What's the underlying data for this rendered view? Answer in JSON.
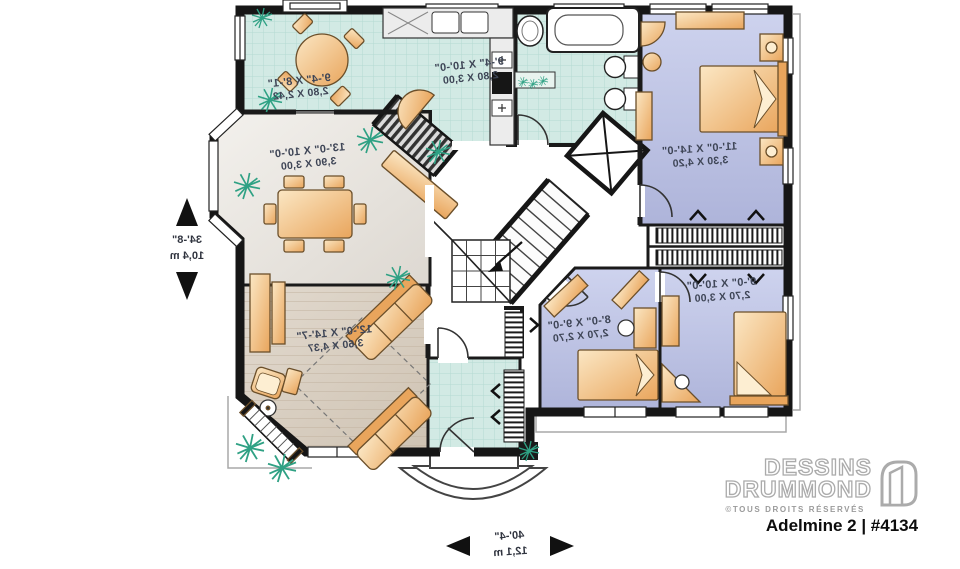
{
  "plan": {
    "rooms": {
      "breakfast": {
        "imperial": "9'-4\" X 8'-1\"",
        "metric": "2,80 X 2,42"
      },
      "kitchen": {
        "imperial": "9'-4\" X 10'-0\"",
        "metric": "2,80 X 3,00"
      },
      "dining": {
        "imperial": "13'-0\" X 10'-0\"",
        "metric": "3,90 X 3,00"
      },
      "living": {
        "imperial": "12'-0\" X 14'-7\"",
        "metric": "3,60 X 4,37"
      },
      "master_bedroom": {
        "imperial": "11'-0\" X 14'-0\"",
        "metric": "3,30 X 4,20"
      },
      "bedroom_2": {
        "imperial": "8'-0\" X 9'-0\"",
        "metric": "2,70 X 2,70"
      },
      "bedroom_3": {
        "imperial": "9'-0\" X 10'-0\"",
        "metric": "2,70 X 3,00"
      }
    },
    "overall_dimensions": {
      "depth_imperial": "34'-8\"",
      "depth_metric": "10,4 m",
      "width_imperial": "40'-4\"",
      "width_metric": "12,1 m"
    }
  },
  "branding": {
    "brand_line1": "DESSINS",
    "brand_line2": "DRUMMOND",
    "rights": "©TOUS DROITS RÉSERVÉS",
    "plan_name": "Adelmine 2 | #4134"
  },
  "colors": {
    "wall": "#1a1a1a",
    "tile_floor": "#d2eae4",
    "bedroom_floor": "#bcc2e4",
    "dining_floor": "#e9e5df",
    "living_floor": "#d8cec1",
    "furniture_wood": "#edb06b",
    "plant_green": "#2fa184",
    "logo_grey": "#ababab",
    "label_text": "#3e4556"
  }
}
